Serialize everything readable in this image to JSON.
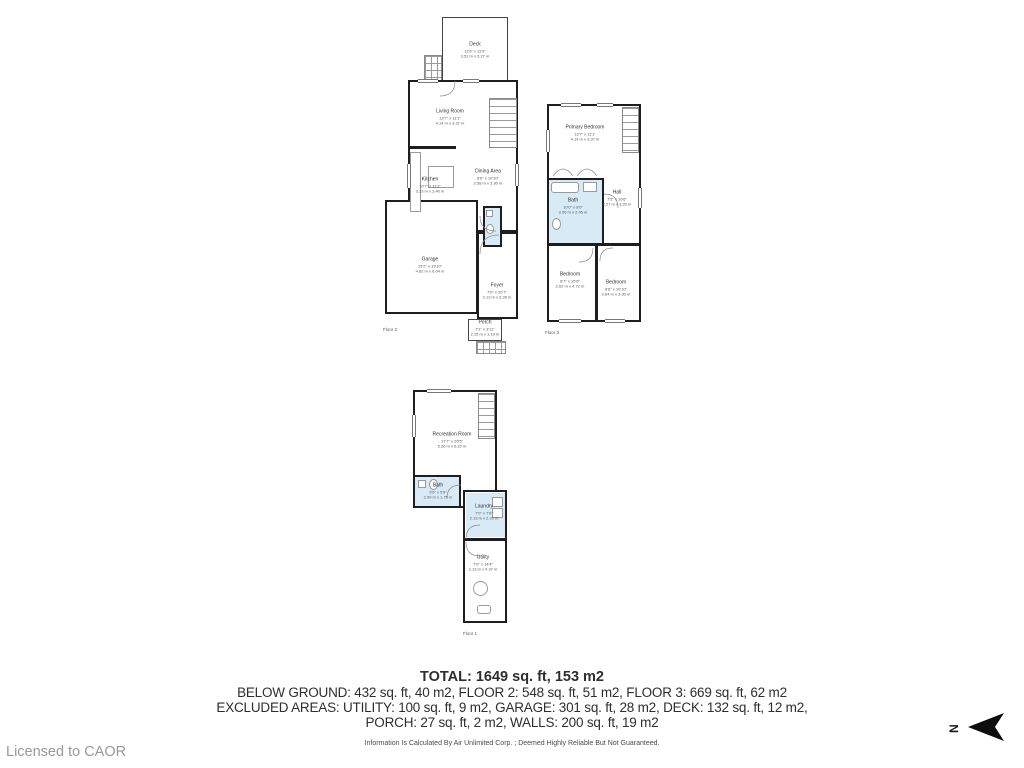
{
  "colors": {
    "wall": "#1e1e1e",
    "bath_fill": "#d9eaf7",
    "thin_line": "#8a8a8a"
  },
  "north": {
    "label": "N"
  },
  "licensed": "Licensed to CAOR",
  "disclaimer": "Information Is Calculated By Air Unlimited Corp. ; Deemed Highly Reliable But Not Guaranteed.",
  "summary": {
    "total": "TOTAL: 1649 sq. ft, 153 m2",
    "line2": "BELOW GROUND: 432 sq. ft, 40 m2, FLOOR 2: 548 sq. ft, 51 m2, FLOOR 3: 669 sq. ft, 62 m2",
    "line3": "EXCLUDED AREAS: UTILITY: 100 sq. ft, 9 m2, GARAGE: 301 sq. ft, 28 m2, DECK: 132 sq. ft, 12 m2,",
    "line4": "PORCH: 27 sq. ft, 2 m2, WALLS: 200 sq. ft, 19 m2"
  },
  "floors": {
    "floor2": {
      "label": "Floor 2",
      "rooms": {
        "deck": {
          "name": "Deck",
          "imperial": "11'6\" x 11'9\"",
          "metric": "3.51 m x 3.27 m"
        },
        "living": {
          "name": "Living Room",
          "imperial": "13'7\" x 11'1\"",
          "metric": "4.14 m x 3.37 m"
        },
        "kitchen": {
          "name": "Kitchen",
          "imperial": "10'7\" x 11'2\"",
          "metric": "3.23 m x 3.40 m"
        },
        "dining": {
          "name": "Dining Area",
          "imperial": "8'6\" x 10'10\"",
          "metric": "2.58 m x 3.30 m"
        },
        "garage": {
          "name": "Garage",
          "imperial": "15'2\" x 19'10\"",
          "metric": "4.62 m x 6.04 m"
        },
        "foyer": {
          "name": "Foyer",
          "imperial": "7'0\" x 20'7\"",
          "metric": "2.13 m x 6.28 m"
        },
        "porch": {
          "name": "Porch",
          "imperial": "7'1\" x 3'11\"",
          "metric": "2.15 m x 1.19 m"
        }
      }
    },
    "floor3": {
      "label": "Floor 3",
      "rooms": {
        "primary": {
          "name": "Primary Bedroom",
          "imperial": "13'7\" x 11'1\"",
          "metric": "4.14 m x 3.37 m"
        },
        "bath": {
          "name": "Bath",
          "imperial": "10'0\" x 8'0\"",
          "metric": "3.06 m x 2.45 m"
        },
        "hall": {
          "name": "Hall",
          "imperial": "7'5\" x 10'6\"",
          "metric": "2.27 m x 3.20 m"
        },
        "bedroom1": {
          "name": "Bedroom",
          "imperial": "8'7\" x 15'6\"",
          "metric": "2.62 m x 4.72 m"
        },
        "bedroom2": {
          "name": "Bedroom",
          "imperial": "8'8\" x 10'10\"",
          "metric": "2.64 m x 3.30 m"
        }
      }
    },
    "floor1": {
      "label": "Floor 1",
      "rooms": {
        "rec": {
          "name": "Recreation Room",
          "imperial": "17'7\" x 20'5\"",
          "metric": "5.36 m x 6.22 m"
        },
        "bath": {
          "name": "Bath",
          "imperial": "9'6\" x 5'9\"",
          "metric": "2.90 m x 1.75 m"
        },
        "laundry": {
          "name": "Laundry",
          "imperial": "7'0\" x 7'6\"",
          "metric": "2.13 m x 2.29 m"
        },
        "utility": {
          "name": "Utility",
          "imperial": "7'0\" x 14'4\"",
          "metric": "2.13 m x 4.37 m"
        }
      }
    }
  }
}
